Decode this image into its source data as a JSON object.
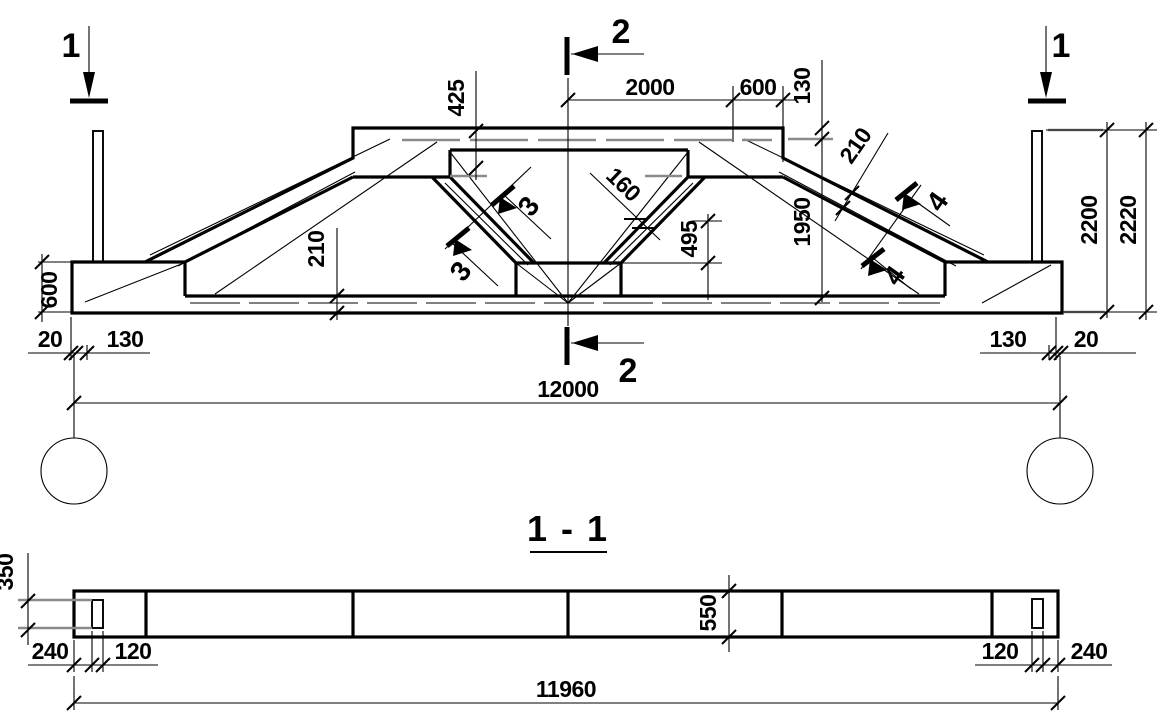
{
  "colors": {
    "line": "#000000",
    "reinforcement_gray": "#8a8a8a",
    "background": "#ffffff"
  },
  "views": {
    "section_title": "1 - 1"
  },
  "markers": {
    "cut1": "1",
    "cut2": "2",
    "cut3": "3",
    "cut4": "4"
  },
  "elev": {
    "d425": "425",
    "d2000": "2000",
    "d600_top": "600",
    "d130_cover": "130",
    "d210_haunch": "210",
    "d1950": "1950",
    "d2200": "2200",
    "d2220": "2220",
    "d160": "160",
    "d495": "495",
    "d210_chord": "210",
    "d600_support": "600",
    "d20_left": "20",
    "d130_left": "130",
    "d130_right": "130",
    "d20_right": "20",
    "d12000": "12000"
  },
  "sect": {
    "d350": "350",
    "d240_left": "240",
    "d120_left": "120",
    "d550": "550",
    "d120_right": "120",
    "d240_right": "240",
    "d11960": "11960"
  }
}
